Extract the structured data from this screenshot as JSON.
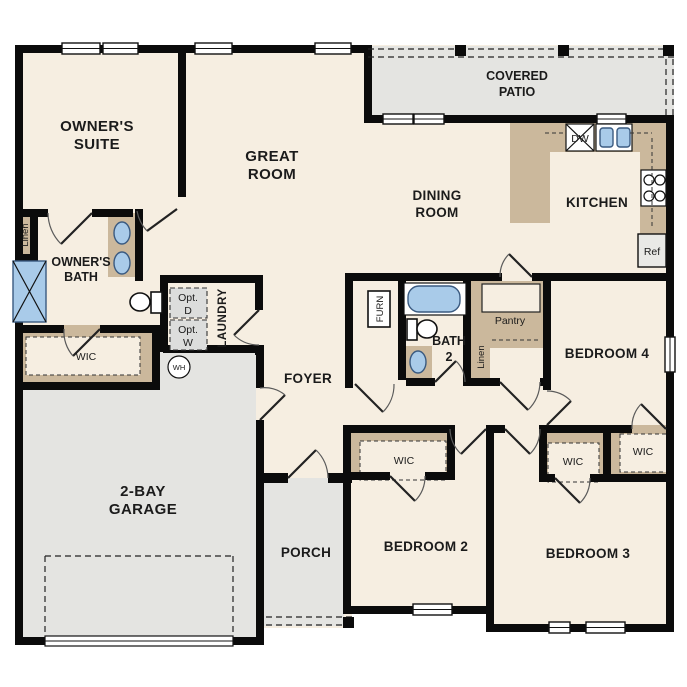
{
  "plan_title": "Single-story 4-bedroom floor plan",
  "colors": {
    "floor": "#f6eee1",
    "outdoor": "#e4e4e1",
    "casework": "#cbb89c",
    "fixture_blue": "#a9cbe9",
    "wall": "#0b0b0b",
    "appliance": "#e9e9e6",
    "opt_box": "#dcdddc"
  },
  "labels": {
    "owners_suite": [
      "OWNER'S",
      "SUITE"
    ],
    "great_room": [
      "GREAT",
      "ROOM"
    ],
    "covered_patio": [
      "COVERED",
      "PATIO"
    ],
    "dining_room": [
      "DINING",
      "ROOM"
    ],
    "kitchen": "KITCHEN",
    "owners_bath": [
      "OWNER'S",
      "BATH"
    ],
    "wic_owner": "WIC",
    "laundry": "LAUNDRY",
    "foyer": "FOYER",
    "garage": [
      "2-BAY",
      "GARAGE"
    ],
    "porch": "PORCH",
    "bath2": [
      "BATH",
      "2"
    ],
    "bedroom2": "BEDROOM 2",
    "bedroom3": "BEDROOM 3",
    "bedroom4": "BEDROOM 4",
    "wic_bed2": "WIC",
    "wic_bed3": "WIC",
    "wic_bed4": "WIC",
    "pantry": "Pantry",
    "linen_owner": "Linen",
    "linen_hall": "Linen",
    "furnace": "FURN",
    "water_heater": "WH",
    "dishwasher": "DW",
    "refrigerator": "Ref",
    "opt_dryer": [
      "Opt.",
      "D"
    ],
    "opt_washer": [
      "Opt.",
      "W"
    ]
  }
}
